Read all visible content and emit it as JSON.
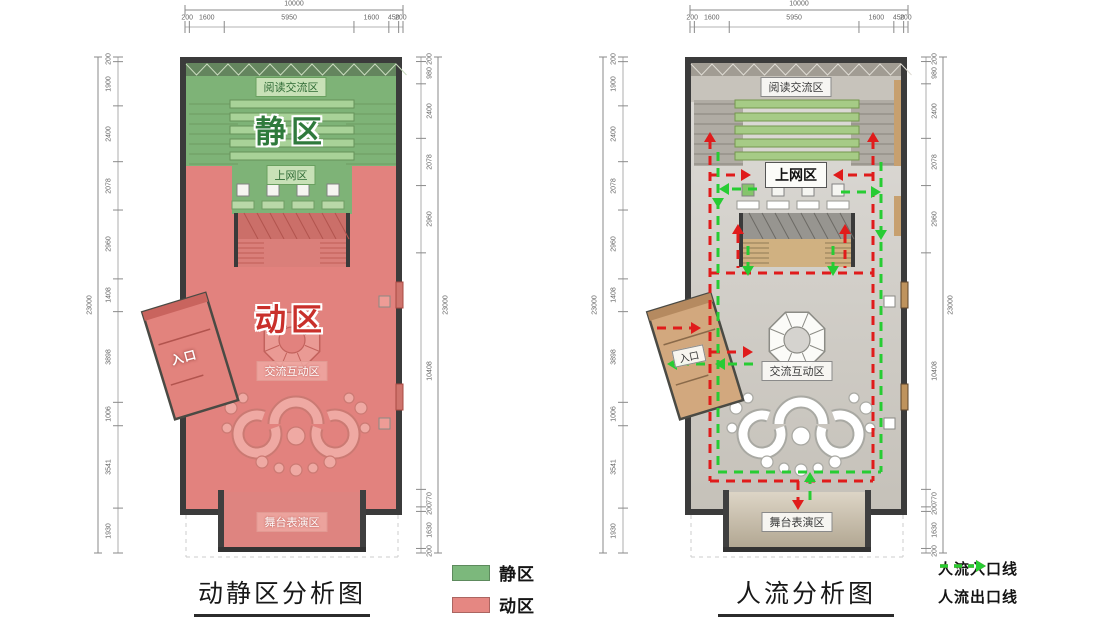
{
  "left_panel": {
    "title": "动静区分析图",
    "labels": {
      "reading": "阅读交流区",
      "quiet_big": "静区",
      "internet": "上网区",
      "active_big": "动区",
      "interact": "交流互动区",
      "stage": "舞台表演区",
      "entrance": "入口"
    }
  },
  "right_panel": {
    "title": "人流分析图",
    "labels": {
      "reading": "阅读交流区",
      "internet": "上网区",
      "interact": "交流互动区",
      "stage": "舞台表演区",
      "entrance": "入口"
    }
  },
  "legend_zones": {
    "items": [
      {
        "label": "静区",
        "color": "#7cb87c"
      },
      {
        "label": "动区",
        "color": "#e58782"
      }
    ]
  },
  "legend_flow": {
    "items": [
      {
        "label": "人流入口线",
        "color": "#e01b1b"
      },
      {
        "label": "人流出口线",
        "color": "#27cc33"
      }
    ]
  },
  "dimensions": {
    "top": {
      "total": "10000",
      "segments": [
        "200",
        "1600",
        "5950",
        "1600",
        "450",
        "200"
      ]
    },
    "left_col": {
      "total": "23000",
      "segments": [
        "200",
        "1900",
        "2400",
        "2078",
        "2960",
        "1408",
        "3898",
        "1006",
        "3541",
        "1930"
      ]
    },
    "right_col": {
      "total": "23000",
      "segments": [
        "200",
        "980",
        "2400",
        "2078",
        "2960",
        "10408",
        "770",
        "200",
        "1630",
        "200"
      ]
    }
  },
  "colors": {
    "quiet_green": "#7eb377",
    "active_red": "#e2827e",
    "flow_in_red": "#e01b1b",
    "flow_out_green": "#27cc33"
  }
}
